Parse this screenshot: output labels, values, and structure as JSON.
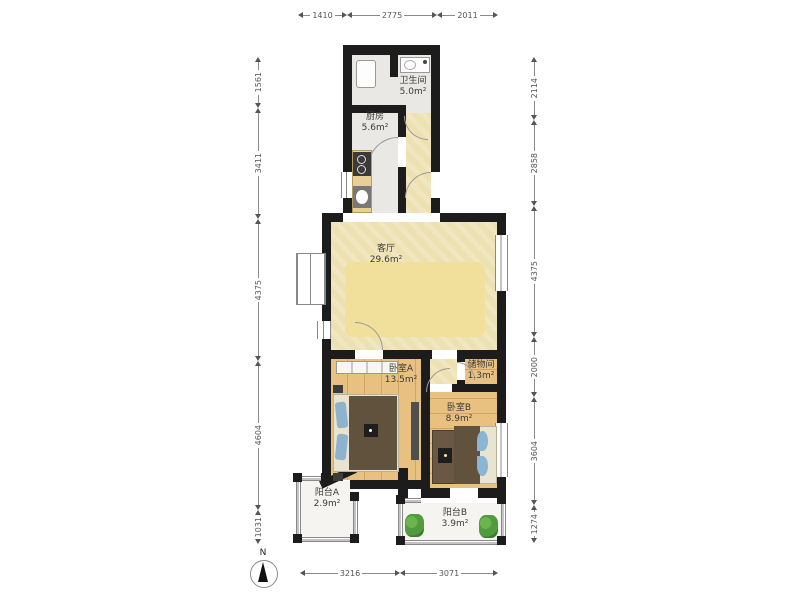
{
  "compass": {
    "n": "N"
  },
  "rooms": {
    "bathroom": {
      "name": "卫生间",
      "area": "5.0m²"
    },
    "kitchen": {
      "name": "厨房",
      "area": "5.6m²"
    },
    "living": {
      "name": "客厅",
      "area": "29.6m²"
    },
    "bedroom_a": {
      "name": "卧室A",
      "area": "13.5m²"
    },
    "storage": {
      "name": "储物间",
      "area": "1.3m²"
    },
    "bedroom_b": {
      "name": "卧室B",
      "area": "8.9m²"
    },
    "balcony_a": {
      "name": "阳台A",
      "area": "2.9m²"
    },
    "balcony_b": {
      "name": "阳台B",
      "area": "3.9m²"
    }
  },
  "dims": {
    "top": [
      "1410",
      "2775",
      "2011"
    ],
    "bottom": [
      "3216",
      "3071"
    ],
    "left": [
      "1561",
      "3411",
      "4375",
      "4604",
      "1031"
    ],
    "right": [
      "2114",
      "2858",
      "4375",
      "2000",
      "3604",
      "1274"
    ]
  },
  "colors": {
    "wall": "#1c1c1c",
    "living_floor": "#ede1b2",
    "wood_floor": "#e6bf7e",
    "gray_floor": "#e9e8e4",
    "plant": "#4f9b3d"
  }
}
